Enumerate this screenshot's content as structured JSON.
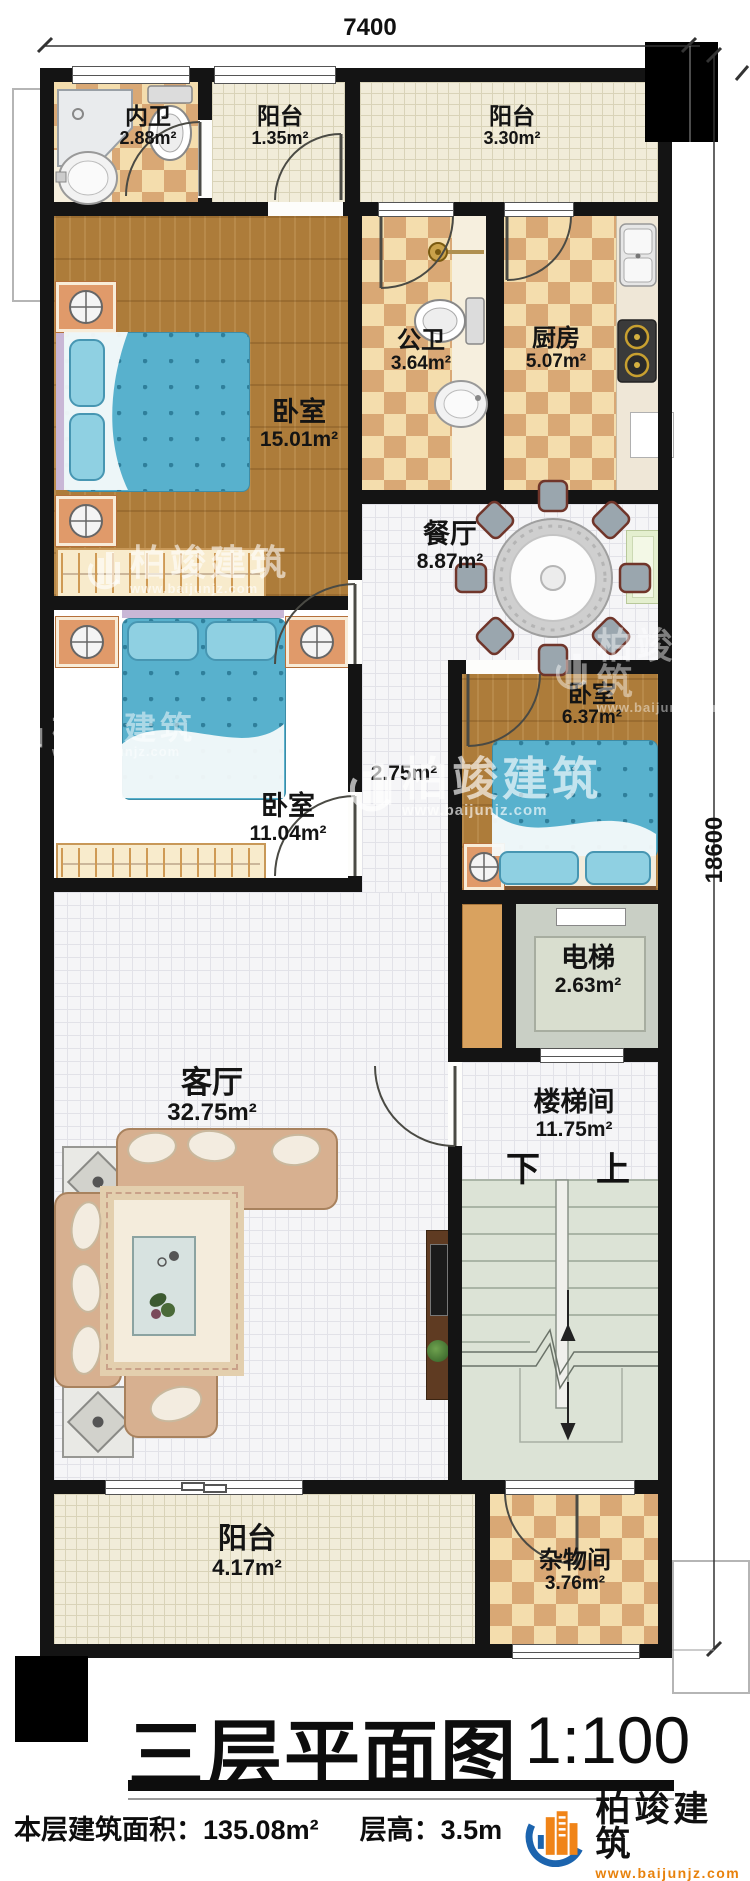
{
  "plan": {
    "dim_width": "7400",
    "dim_height": "18600",
    "stair_down": "下",
    "stair_up": "上"
  },
  "rooms": [
    {
      "name": "内卫",
      "area": "2.88m²"
    },
    {
      "name": "阳台",
      "area": "1.35m²"
    },
    {
      "name": "阳台",
      "area": "3.30m²"
    },
    {
      "name": "卧室",
      "area": "15.01m²"
    },
    {
      "name": "公卫",
      "area": "3.64m²"
    },
    {
      "name": "厨房",
      "area": "5.07m²"
    },
    {
      "name": "餐厅",
      "area": "8.87m²"
    },
    {
      "name": "卧室",
      "area": "11.04m²"
    },
    {
      "name": "",
      "area": "2.75m²"
    },
    {
      "name": "卧室",
      "area": "6.37m²"
    },
    {
      "name": "电梯",
      "area": "2.63m²"
    },
    {
      "name": "客厅",
      "area": "32.75m²"
    },
    {
      "name": "楼梯间",
      "area": "11.75m²"
    },
    {
      "name": "阳台",
      "area": "4.17m²"
    },
    {
      "name": "杂物间",
      "area": "3.76m²"
    }
  ],
  "title": {
    "text": "三层平面图",
    "scale": "1:100"
  },
  "footer": {
    "area": "本层建筑面积：135.08m²",
    "floor_height": "层高：3.5m"
  },
  "brand": {
    "name": "柏竣建筑",
    "url": "www.baijunjz.com"
  },
  "watermark": {
    "name": "柏竣建筑",
    "url": "www.baijunjz.com"
  }
}
